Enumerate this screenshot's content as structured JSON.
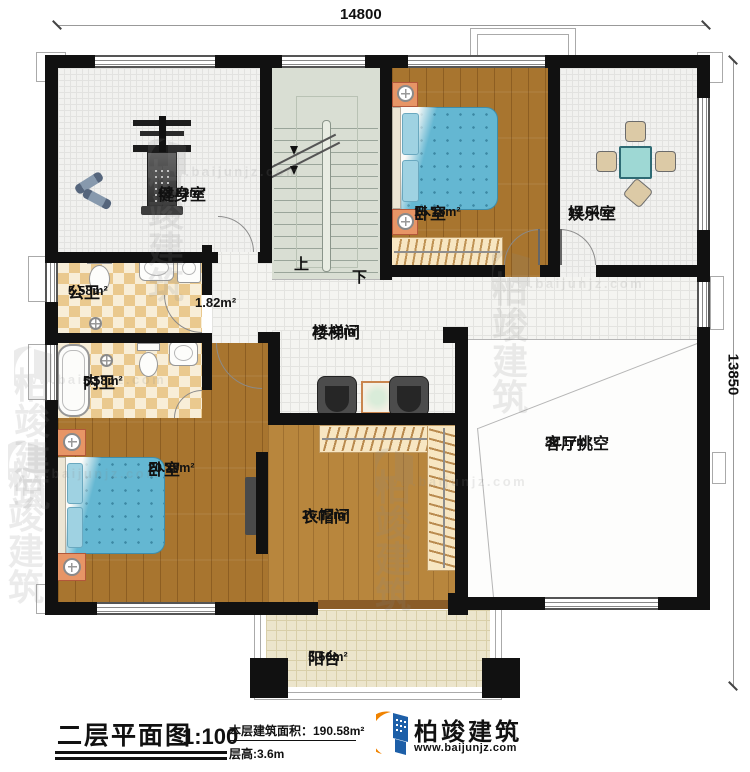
{
  "dimensions": {
    "width": "14800",
    "height": "13850"
  },
  "stairs": {
    "up": "上",
    "down": "下"
  },
  "rooms": {
    "gym": {
      "name": "健身室",
      "area": "18.82m²"
    },
    "bedroom_top": {
      "name": "卧室",
      "area": "15.15m²"
    },
    "entertainment": {
      "name": "娱乐室",
      "area": "14.64m²"
    },
    "public_bath": {
      "name": "公卫",
      "area": "5.58m²"
    },
    "vestibule": {
      "area": "1.82m²"
    },
    "stairwell": {
      "name": "楼梯间",
      "area": "25.45m²"
    },
    "private_bath": {
      "name": "内卫",
      "area": "5.58m²"
    },
    "bedroom_bottom": {
      "name": "卧室",
      "area": "20.39m²"
    },
    "cloakroom": {
      "name": "衣帽间",
      "area": "16.72m²"
    },
    "living_void": {
      "name": "客厅挑空",
      "area": "39.17m²"
    },
    "balcony": {
      "name": "阳台",
      "area": "5.50m²"
    }
  },
  "title_block": {
    "title": "二层平面图",
    "scale": "1:100",
    "area_line": "本层建筑面积：190.58m²",
    "height_line": "层高:3.6m"
  },
  "brand": {
    "name": "柏竣建筑",
    "url": "www.baijunjz.com"
  },
  "watermark": {
    "text": "柏竣建筑",
    "url": "www.baijunjz.com"
  },
  "colors": {
    "accent_blue": "#1d5fa8",
    "accent_orange": "#f08300",
    "wall": "#111111"
  }
}
